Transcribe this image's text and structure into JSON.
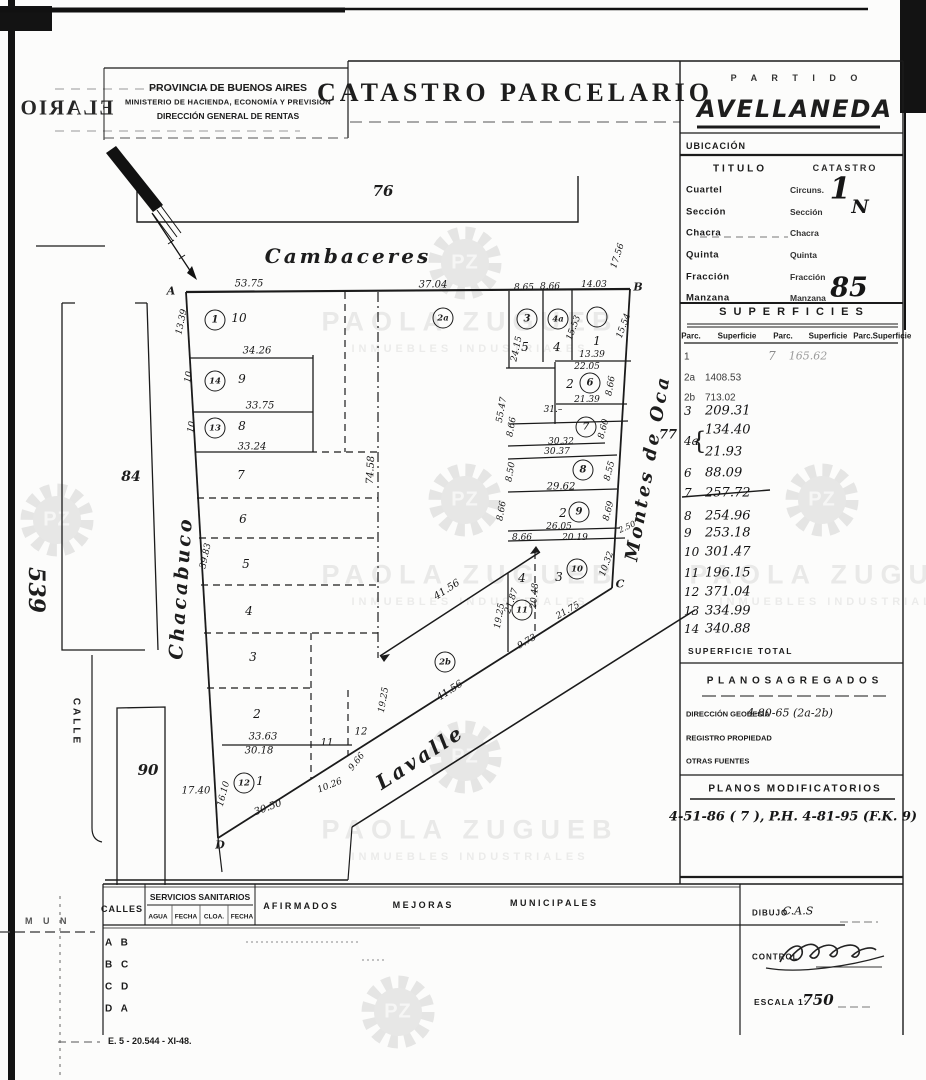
{
  "header": {
    "left": {
      "l1": "PROVINCIA DE BUENOS AIRES",
      "l2": "MINISTERIO DE HACIENDA, ECONOMÍA Y PREVISIÓN",
      "l3": "DIRECCIÓN GENERAL DE RENTAS"
    },
    "title": "CATASTRO  PARCELARIO",
    "partido": "P A R T I D O",
    "partido_name": "AVELLANEDA"
  },
  "panel": {
    "ubicacion": "UBICACIÓN",
    "titulo": "TITULO",
    "catastro": "CATASTRO",
    "location": {
      "titulo_rows": [
        "Cuartel",
        "Sección",
        "Chacra",
        "Quinta",
        "Fracción",
        "Manzana"
      ],
      "catastro_rows": [
        "Circuns.",
        "Sección",
        "Chacra",
        "Quinta",
        "Fracción",
        "Manzana"
      ],
      "circ_value": "1",
      "circ_sub": "N",
      "manzana_value": "85"
    },
    "superficies": {
      "title": "S U P E R F I C I E S",
      "headers": [
        "Parc.",
        "Superficie",
        "Parc.",
        "Superficie",
        "Parc.",
        "Superficie"
      ],
      "brace": "{",
      "rows": [
        {
          "p": "1",
          "v": "",
          "y": 357,
          "f": "t"
        },
        {
          "p": "2a",
          "v": "1408.53",
          "y": 378,
          "f": "t"
        },
        {
          "p": "2b",
          "v": "713.02",
          "y": 398,
          "f": "t"
        },
        {
          "p": "3",
          "v": "209.31",
          "y": 411
        },
        {
          "p": "4a",
          "v": "134.40",
          "y": 430,
          "py": 441
        },
        {
          "p": "",
          "v": "21.93",
          "y": 452
        },
        {
          "p": "6",
          "v": "88.09",
          "y": 473
        },
        {
          "p": "7",
          "v": "257.72",
          "y": 493,
          "strike": true
        },
        {
          "p": "8",
          "v": "254.96",
          "y": 516
        },
        {
          "p": "9",
          "v": "253.18",
          "y": 533
        },
        {
          "p": "10",
          "v": "301.47",
          "y": 552
        },
        {
          "p": "11",
          "v": "196.15",
          "y": 573
        },
        {
          "p": "12",
          "v": "371.04",
          "y": 592
        },
        {
          "p": "13",
          "v": "334.99",
          "y": 611
        },
        {
          "p": "14",
          "v": "340.88",
          "y": 629
        }
      ],
      "extra": {
        "p": "7",
        "v": "165.62"
      },
      "total": "SUPERFICIE TOTAL"
    },
    "agregados": {
      "title": "P L A N O S   A G R E G A D O S",
      "geodesia_label": "DIRECCIÓN GEODESIA",
      "geodesia_value": "4-80-65 (2a-2b)",
      "registro_label": "REGISTRO PROPIEDAD",
      "otras_label": "OTRAS FUENTES"
    },
    "modificatorios": {
      "title": "PLANOS MODIFICATORIOS",
      "value": "4-51-86 ( 7 ), P.H. 4-81-95 (F.K. 9)"
    }
  },
  "footer": {
    "calles": "CALLES",
    "servicios": "SERVICIOS SANITARIOS",
    "sub": [
      "AGUA",
      "FECHA",
      "CLOA.",
      "FECHA"
    ],
    "afirmados": "A F I R M A D O S",
    "mejoras": "M E J O R A S",
    "municipales": "M U N I C I P A L E S",
    "rows": [
      "A B",
      "B C",
      "C D",
      "D A"
    ],
    "dibujo_label": "DIBUJO",
    "dibujo_value": "C.A.S",
    "control_label": "CONTROL",
    "escala_label": "ESCALA 1:",
    "escala_value": "750",
    "print_ref": "E. 5 - 20.544 - XI-48.",
    "mun": "M U N"
  },
  "artifacts": {
    "bleed_text": "ELARIO"
  },
  "watermark": {
    "initials": "PZ",
    "name": "PAOLA ZUGUEB",
    "subtitle": "INMUEBLES INDUSTRIALES",
    "texts": [
      {
        "x": 470,
        "y": 322
      },
      {
        "x": 470,
        "y": 575
      },
      {
        "x": 838,
        "y": 575
      },
      {
        "x": 470,
        "y": 830
      }
    ],
    "gears": [
      {
        "x": 465,
        "y": 263
      },
      {
        "x": 57,
        "y": 520
      },
      {
        "x": 465,
        "y": 500
      },
      {
        "x": 822,
        "y": 500
      },
      {
        "x": 465,
        "y": 757
      },
      {
        "x": 398,
        "y": 1012
      }
    ]
  },
  "map": {
    "circles": [
      {
        "n": "1",
        "x": 215,
        "y": 320
      },
      {
        "n": "14",
        "x": 215,
        "y": 381
      },
      {
        "n": "13",
        "x": 215,
        "y": 428
      },
      {
        "n": "2a",
        "x": 443,
        "y": 318
      },
      {
        "n": "3",
        "x": 527,
        "y": 319
      },
      {
        "n": "4a",
        "x": 558,
        "y": 319
      },
      {
        "n": "",
        "x": 597,
        "y": 317
      },
      {
        "n": "6",
        "x": 590,
        "y": 383
      },
      {
        "n": "7",
        "x": 586,
        "y": 427
      },
      {
        "n": "8",
        "x": 583,
        "y": 470
      },
      {
        "n": "9",
        "x": 579,
        "y": 512
      },
      {
        "n": "10",
        "x": 577,
        "y": 569
      },
      {
        "n": "11",
        "x": 522,
        "y": 610
      },
      {
        "n": "2b",
        "x": 445,
        "y": 662
      },
      {
        "n": "12",
        "x": 244,
        "y": 783
      }
    ],
    "labels": [
      {
        "t": "Cambaceres",
        "x": 348,
        "y": 256,
        "s": 20,
        "k": "s"
      },
      {
        "t": "Chacabuco",
        "x": 181,
        "y": 588,
        "r": -86,
        "s": 19,
        "k": "s"
      },
      {
        "t": "Montes de Oca",
        "x": 648,
        "y": 468,
        "r": -80,
        "s": 18,
        "k": "s"
      },
      {
        "t": "Lavalle",
        "x": 420,
        "y": 757,
        "r": -33,
        "s": 20,
        "k": "s"
      },
      {
        "t": "CALLE",
        "x": 76,
        "y": 722,
        "r": 90,
        "k": "t"
      },
      {
        "t": "76",
        "x": 383,
        "y": 191,
        "k": "b"
      },
      {
        "t": "84",
        "x": 131,
        "y": 477,
        "s": 14,
        "k": "b"
      },
      {
        "t": "90",
        "x": 148,
        "y": 770,
        "k": "b"
      },
      {
        "t": "77",
        "x": 668,
        "y": 435,
        "s": 13,
        "k": "b"
      },
      {
        "t": "539",
        "x": 36,
        "y": 590,
        "r": 90,
        "s": 22,
        "k": "b"
      },
      {
        "t": "A",
        "x": 171,
        "y": 291,
        "k": "c"
      },
      {
        "t": "B",
        "x": 638,
        "y": 287,
        "k": "c"
      },
      {
        "t": "C",
        "x": 620,
        "y": 584,
        "k": "c"
      },
      {
        "t": "D",
        "x": 220,
        "y": 845,
        "k": "c"
      },
      {
        "t": "10",
        "x": 239,
        "y": 318,
        "k": "p"
      },
      {
        "t": "9",
        "x": 242,
        "y": 379,
        "k": "p"
      },
      {
        "t": "8",
        "x": 242,
        "y": 426,
        "k": "p"
      },
      {
        "t": "7",
        "x": 241,
        "y": 475,
        "k": "p"
      },
      {
        "t": "6",
        "x": 243,
        "y": 519,
        "k": "p"
      },
      {
        "t": "5",
        "x": 246,
        "y": 564,
        "k": "p"
      },
      {
        "t": "4",
        "x": 249,
        "y": 611,
        "k": "p"
      },
      {
        "t": "3",
        "x": 253,
        "y": 657,
        "k": "p"
      },
      {
        "t": "2",
        "x": 257,
        "y": 714,
        "k": "p"
      },
      {
        "t": "1",
        "x": 260,
        "y": 781,
        "k": "p"
      },
      {
        "t": "11",
        "x": 327,
        "y": 743,
        "s": 10,
        "k": "p"
      },
      {
        "t": "12",
        "x": 361,
        "y": 732,
        "s": 10,
        "k": "p"
      },
      {
        "t": "5",
        "x": 525,
        "y": 347,
        "k": "p"
      },
      {
        "t": "4",
        "x": 557,
        "y": 347,
        "k": "p"
      },
      {
        "t": "1",
        "x": 597,
        "y": 341,
        "k": "p"
      },
      {
        "t": "2",
        "x": 570,
        "y": 384,
        "k": "p"
      },
      {
        "t": "2",
        "x": 563,
        "y": 513,
        "k": "p"
      },
      {
        "t": "3",
        "x": 559,
        "y": 577,
        "k": "p"
      },
      {
        "t": "4",
        "x": 522,
        "y": 578,
        "k": "p"
      },
      {
        "t": "53.75",
        "x": 249,
        "y": 284,
        "k": "m"
      },
      {
        "t": "37.04",
        "x": 433,
        "y": 285,
        "k": "m"
      },
      {
        "t": "8.65",
        "x": 524,
        "y": 288,
        "s": 9,
        "k": "m"
      },
      {
        "t": "8.66",
        "x": 550,
        "y": 287,
        "s": 9,
        "k": "m"
      },
      {
        "t": "14.03",
        "x": 594,
        "y": 285,
        "s": 9,
        "k": "m"
      },
      {
        "t": "17.56",
        "x": 618,
        "y": 256,
        "r": -72,
        "s": 9,
        "k": "m"
      },
      {
        "t": "13.39",
        "x": 182,
        "y": 322,
        "r": -78,
        "s": 9,
        "k": "m"
      },
      {
        "t": "10",
        "x": 189,
        "y": 377,
        "r": -80,
        "s": 9,
        "k": "m"
      },
      {
        "t": "10",
        "x": 192,
        "y": 427,
        "r": -80,
        "s": 9,
        "k": "m"
      },
      {
        "t": "34.26",
        "x": 257,
        "y": 351,
        "k": "m"
      },
      {
        "t": "33.75",
        "x": 260,
        "y": 406,
        "k": "m"
      },
      {
        "t": "33.24",
        "x": 252,
        "y": 447,
        "k": "m"
      },
      {
        "t": "39.83",
        "x": 206,
        "y": 556,
        "r": -78,
        "s": 9,
        "k": "m"
      },
      {
        "t": "74.58",
        "x": 371,
        "y": 470,
        "r": -87,
        "k": "m"
      },
      {
        "t": "17.40",
        "x": 196,
        "y": 791,
        "k": "m"
      },
      {
        "t": "16.10",
        "x": 224,
        "y": 794,
        "r": -75,
        "s": 9,
        "k": "m"
      },
      {
        "t": "33.63",
        "x": 263,
        "y": 737,
        "k": "m"
      },
      {
        "t": "30.18",
        "x": 259,
        "y": 751,
        "k": "m"
      },
      {
        "t": "30.50",
        "x": 268,
        "y": 808,
        "r": -20,
        "k": "m"
      },
      {
        "t": "10.26",
        "x": 330,
        "y": 786,
        "r": -22,
        "s": 9,
        "k": "m"
      },
      {
        "t": "9.66",
        "x": 357,
        "y": 762,
        "r": -52,
        "s": 9,
        "k": "m"
      },
      {
        "t": "19.25",
        "x": 384,
        "y": 700,
        "r": -80,
        "s": 9,
        "k": "m"
      },
      {
        "t": "19.25",
        "x": 500,
        "y": 616,
        "r": -80,
        "s": 9,
        "k": "m"
      },
      {
        "t": "41.56",
        "x": 447,
        "y": 590,
        "r": -33,
        "k": "m"
      },
      {
        "t": "41.56",
        "x": 450,
        "y": 691,
        "r": -33,
        "k": "m"
      },
      {
        "t": "9.73",
        "x": 527,
        "y": 642,
        "r": -30,
        "s": 9,
        "k": "m"
      },
      {
        "t": "21.75",
        "x": 568,
        "y": 611,
        "r": -30,
        "s": 9,
        "k": "m"
      },
      {
        "t": "20.48",
        "x": 535,
        "y": 596,
        "r": -85,
        "s": 9,
        "k": "m"
      },
      {
        "t": "21.87",
        "x": 512,
        "y": 601,
        "r": -72,
        "s": 9,
        "k": "m"
      },
      {
        "t": "24.15",
        "x": 517,
        "y": 349,
        "r": -78,
        "s": 9,
        "k": "m"
      },
      {
        "t": "15.53",
        "x": 574,
        "y": 328,
        "r": -70,
        "s": 9,
        "k": "m"
      },
      {
        "t": "15.54",
        "x": 624,
        "y": 326,
        "r": -70,
        "s": 9,
        "k": "m"
      },
      {
        "t": "13.39",
        "x": 592,
        "y": 355,
        "s": 9,
        "k": "m"
      },
      {
        "t": "22.05",
        "x": 587,
        "y": 367,
        "s": 9,
        "k": "m"
      },
      {
        "t": "21.39",
        "x": 587,
        "y": 400,
        "s": 9,
        "k": "m"
      },
      {
        "t": "31.–",
        "x": 553,
        "y": 410,
        "s": 9,
        "k": "m"
      },
      {
        "t": "55.47",
        "x": 502,
        "y": 410,
        "r": -80,
        "s": 9,
        "k": "m"
      },
      {
        "t": "8.66",
        "x": 512,
        "y": 427,
        "r": -80,
        "s": 9,
        "k": "m"
      },
      {
        "t": "8.66",
        "x": 611,
        "y": 386,
        "r": -80,
        "s": 9,
        "k": "m"
      },
      {
        "t": "30.32",
        "x": 561,
        "y": 442,
        "s": 9,
        "k": "m"
      },
      {
        "t": "30.37",
        "x": 557,
        "y": 452,
        "s": 9,
        "k": "m"
      },
      {
        "t": "8.60",
        "x": 604,
        "y": 429,
        "r": -75,
        "s": 9,
        "k": "m"
      },
      {
        "t": "8.50",
        "x": 511,
        "y": 472,
        "r": -80,
        "s": 9,
        "k": "m"
      },
      {
        "t": "8.55",
        "x": 610,
        "y": 471,
        "r": -75,
        "s": 9,
        "k": "m"
      },
      {
        "t": "29.62",
        "x": 561,
        "y": 487,
        "k": "m"
      },
      {
        "t": "8.66",
        "x": 502,
        "y": 511,
        "r": -80,
        "s": 9,
        "k": "m"
      },
      {
        "t": "8.69",
        "x": 609,
        "y": 511,
        "r": -75,
        "s": 9,
        "k": "m"
      },
      {
        "t": "26.05",
        "x": 559,
        "y": 527,
        "s": 9,
        "k": "m"
      },
      {
        "t": "20.19",
        "x": 575,
        "y": 538,
        "s": 9,
        "k": "m"
      },
      {
        "t": "8.66",
        "x": 522,
        "y": 538,
        "s": 9,
        "k": "m"
      },
      {
        "t": "2.50",
        "x": 627,
        "y": 527,
        "r": -25,
        "s": 8,
        "k": "m"
      },
      {
        "t": "10.32",
        "x": 607,
        "y": 564,
        "r": -70,
        "s": 9,
        "k": "m"
      }
    ]
  }
}
